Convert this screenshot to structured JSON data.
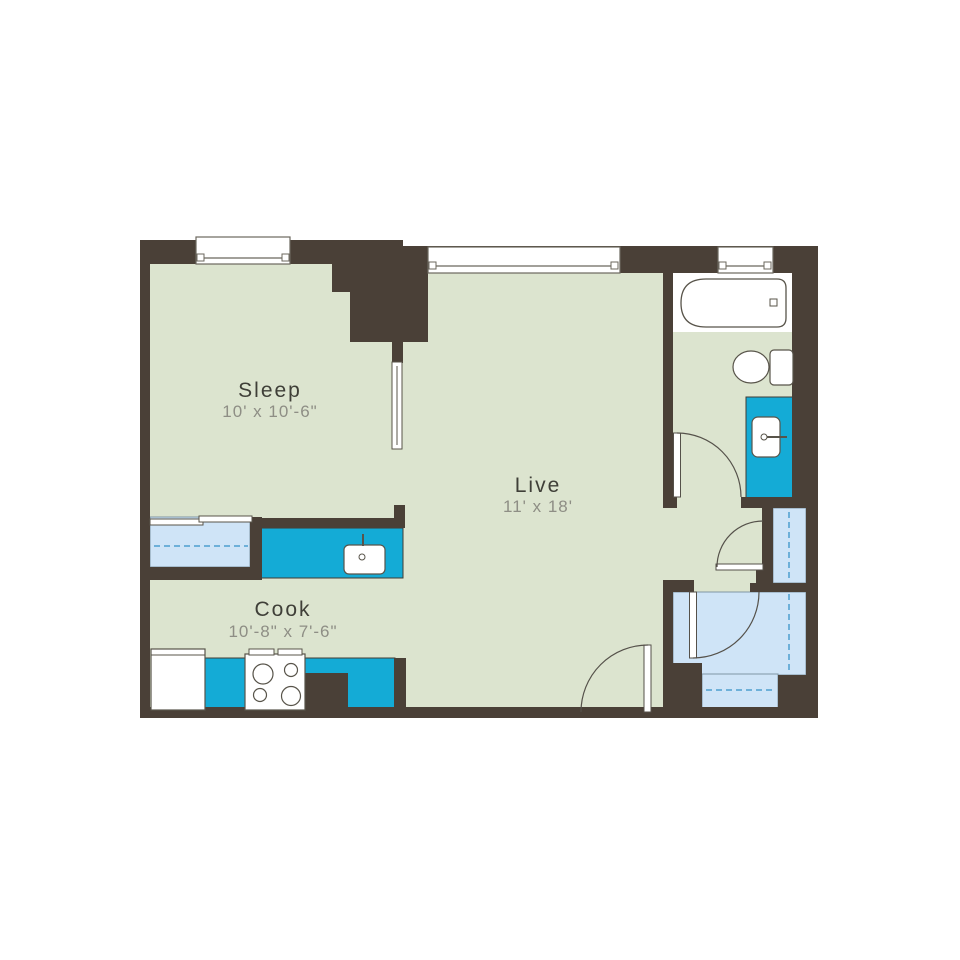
{
  "floor_plan": {
    "rooms": [
      {
        "name": "Sleep",
        "dimensions": "10' x 10'-6\""
      },
      {
        "name": "Live",
        "dimensions": "11' x 18'"
      },
      {
        "name": "Cook",
        "dimensions": "10'-8\" x 7'-6\""
      }
    ],
    "fixtures": [
      "bathtub",
      "toilet",
      "vanity-sink",
      "kitchen-sink",
      "stove-4-burner",
      "refrigerator",
      "sliding-door",
      "closet-sliding-doors",
      "swing-door-bathroom",
      "swing-door-linen-closet",
      "swing-door-walkin-closet",
      "swing-door-entry",
      "window",
      "closet-rod-dashed-line"
    ],
    "colors": {
      "wall": "#4a4037",
      "floor": "#dce4cf",
      "closet_floor": "#cfe4f7",
      "counter_teal": "#14abd6",
      "fixture_outline": "#58544a",
      "closet_dash": "#4d9ecf",
      "room_label": "#3f3f38",
      "dimension_label": "#8e8e85",
      "background": "#ffffff"
    }
  }
}
